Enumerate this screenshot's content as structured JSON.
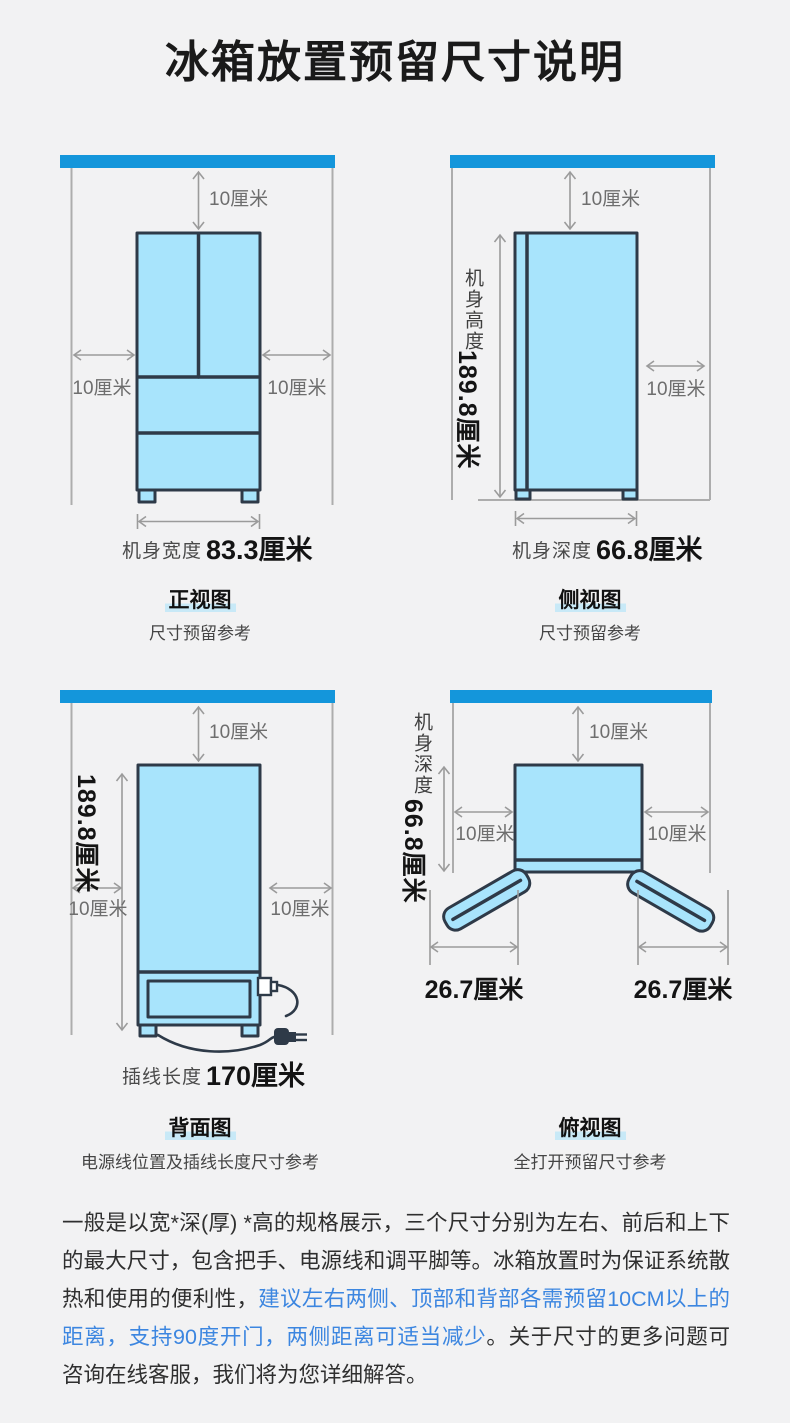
{
  "title": "冰箱放置预留尺寸说明",
  "colors": {
    "accent_blue": "#1496DB",
    "fridge_fill": "#A8E4FC",
    "fridge_stroke": "#2E3A48",
    "title_highlight": "#C8E9F7",
    "paragraph_blue": "#3C86E0",
    "background": "#F2F2F3"
  },
  "panels": {
    "front": {
      "clearance_top": "10厘米",
      "clearance_left": "10厘米",
      "clearance_right": "10厘米",
      "width_label": "机身宽度",
      "width_value": "83.3厘米",
      "view_title": "正视图",
      "view_subtitle": "尺寸预留参考"
    },
    "side": {
      "clearance_top": "10厘米",
      "clearance_right": "10厘米",
      "height_label": "机身高度",
      "height_value": "189.8厘米",
      "depth_label": "机身深度",
      "depth_value": "66.8厘米",
      "view_title": "侧视图",
      "view_subtitle": "尺寸预留参考"
    },
    "back": {
      "clearance_top": "10厘米",
      "clearance_left": "10厘米",
      "clearance_right": "10厘米",
      "height_value": "189.8厘米",
      "cord_label": "插线长度",
      "cord_value": "170厘米",
      "view_title": "背面图",
      "view_subtitle": "电源线位置及插线长度尺寸参考"
    },
    "top": {
      "clearance_top": "10厘米",
      "clearance_left": "10厘米",
      "clearance_right": "10厘米",
      "depth_label": "机身深度",
      "depth_value": "66.8厘米",
      "door_left_value": "26.7厘米",
      "door_right_value": "26.7厘米",
      "view_title": "俯视图",
      "view_subtitle": "全打开预留尺寸参考"
    }
  },
  "footer": {
    "text_before": "一般是以宽*深(厚) *高的规格展示，三个尺寸分别为左右、前后和上下的最大尺寸，包含把手、电源线和调平脚等。冰箱放置时为保证系统散热和使用的便利性，",
    "text_highlight": "建议左右两侧、顶部和背部各需预留10CM以上的距离，支持90度开门，两侧距离可适当减少",
    "text_after": "。关于尺寸的更多问题可咨询在线客服，我们将为您详细解答。"
  }
}
